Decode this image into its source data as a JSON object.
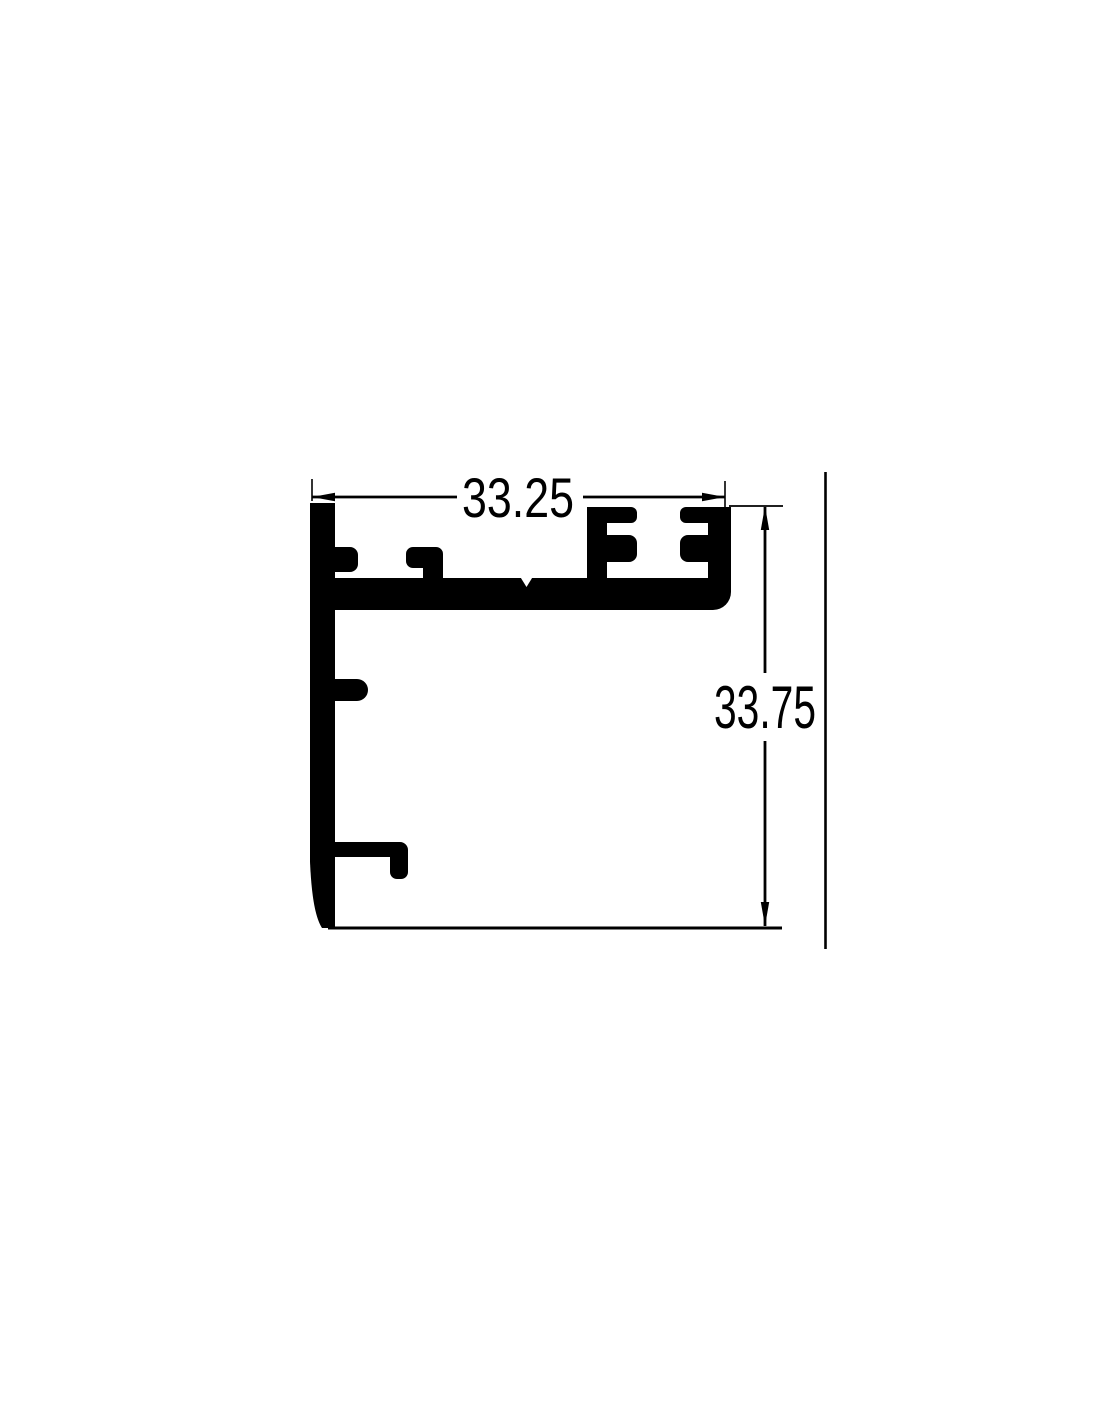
{
  "dimensions": {
    "width": {
      "label": "33.25"
    },
    "height": {
      "label": "33.75"
    }
  },
  "colors": {
    "ink": "#000000",
    "background": "#ffffff"
  }
}
